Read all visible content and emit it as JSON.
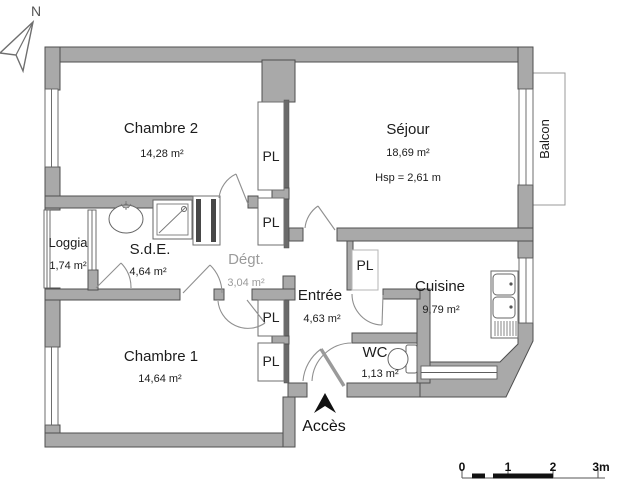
{
  "plan": {
    "compass_label": "N",
    "access_label": "Accès",
    "closet_label": "PL",
    "rooms": {
      "chambre2": {
        "name": "Chambre 2",
        "area": "14,28 m²"
      },
      "sejour": {
        "name": "Séjour",
        "area": "18,69 m²",
        "ceiling": "Hsp = 2,61 m"
      },
      "balcon": {
        "name": "Balcon"
      },
      "loggia": {
        "name": "Loggia",
        "area": "1,74 m²"
      },
      "sde": {
        "name": "S.d.E.",
        "area": "4,64 m²"
      },
      "degt": {
        "name": "Dégt.",
        "area": "3,04 m²"
      },
      "entree": {
        "name": "Entrée",
        "area": "4,63 m²"
      },
      "cuisine": {
        "name": "Cuisine",
        "area": "9,79 m²"
      },
      "chambre1": {
        "name": "Chambre 1",
        "area": "14,64 m²"
      },
      "wc": {
        "name": "WC",
        "area": "1,13 m²"
      }
    },
    "scale": {
      "t0": "0",
      "t1": "1",
      "t2": "2",
      "t3": "3m"
    },
    "colors": {
      "wall": "#a9a9a9",
      "wall_edge": "#4f4f4f",
      "door_arc": "#8f8f8f",
      "text": "#1c1c1c",
      "muted_text": "#9b9b9b",
      "access_arrow": "#111111"
    }
  }
}
